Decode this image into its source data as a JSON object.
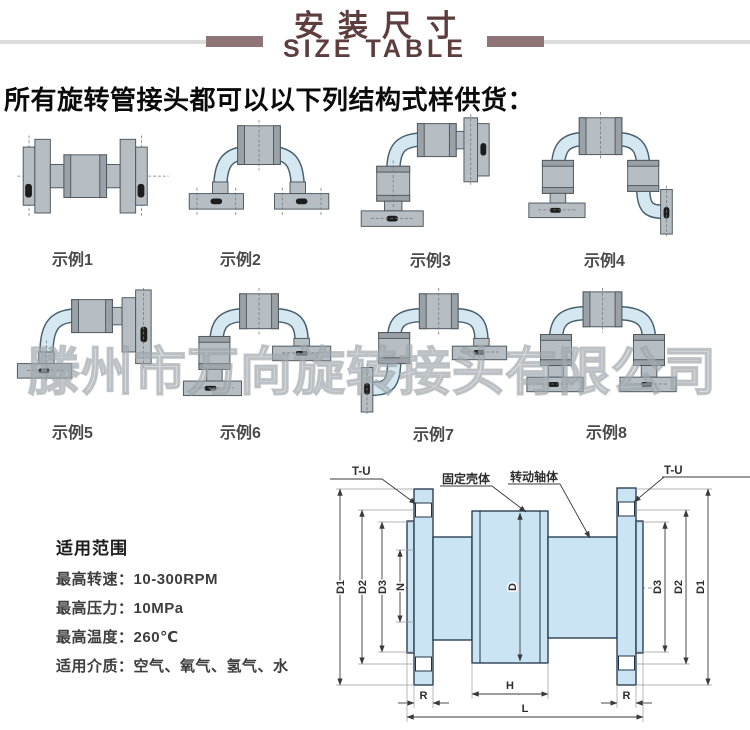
{
  "header": {
    "title_cn": "安装尺寸",
    "title_en": "SIZE TABLE"
  },
  "subtitle": "所有旋转管接头都可以以下列结构式样供货：",
  "examples": [
    {
      "label": "示例1"
    },
    {
      "label": "示例2"
    },
    {
      "label": "示例3"
    },
    {
      "label": "示例4"
    },
    {
      "label": "示例5"
    },
    {
      "label": "示例6"
    },
    {
      "label": "示例7"
    },
    {
      "label": "示例8"
    }
  ],
  "watermark": "滕州市万向旋转接头有限公司",
  "specs": {
    "title": "适用范围",
    "items": [
      {
        "label": "最高转速：",
        "value": "10-300RPM"
      },
      {
        "label": "最高压力：",
        "value": "10MPa"
      },
      {
        "label": "最高温度：",
        "value": "260℃"
      },
      {
        "label": "适用介质：",
        "value": "空气、氧气、氢气、水"
      }
    ]
  },
  "drawing": {
    "tu_left": "T-U",
    "tu_right": "T-U",
    "fixed_housing": "固定壳体",
    "rotating_shaft": "转动轴体",
    "dims": {
      "d1_left": "D1",
      "d2_left": "D2",
      "d3_left": "D3",
      "n": "N",
      "d": "D",
      "d3_right": "D3",
      "d2_right": "D2",
      "d1_right": "D1",
      "r_left": "R",
      "h": "H",
      "r_right": "R",
      "l": "L"
    }
  },
  "colors": {
    "title_maroon": "#5d3d3d",
    "accent_bar": "#8f7578",
    "deco_line": "#dcdcdc",
    "drawing_fill": "#cae4f3",
    "drawing_outline": "#1f3347",
    "part_gray": "#b6bec4",
    "pipe_blue": "#d5e7f1"
  }
}
